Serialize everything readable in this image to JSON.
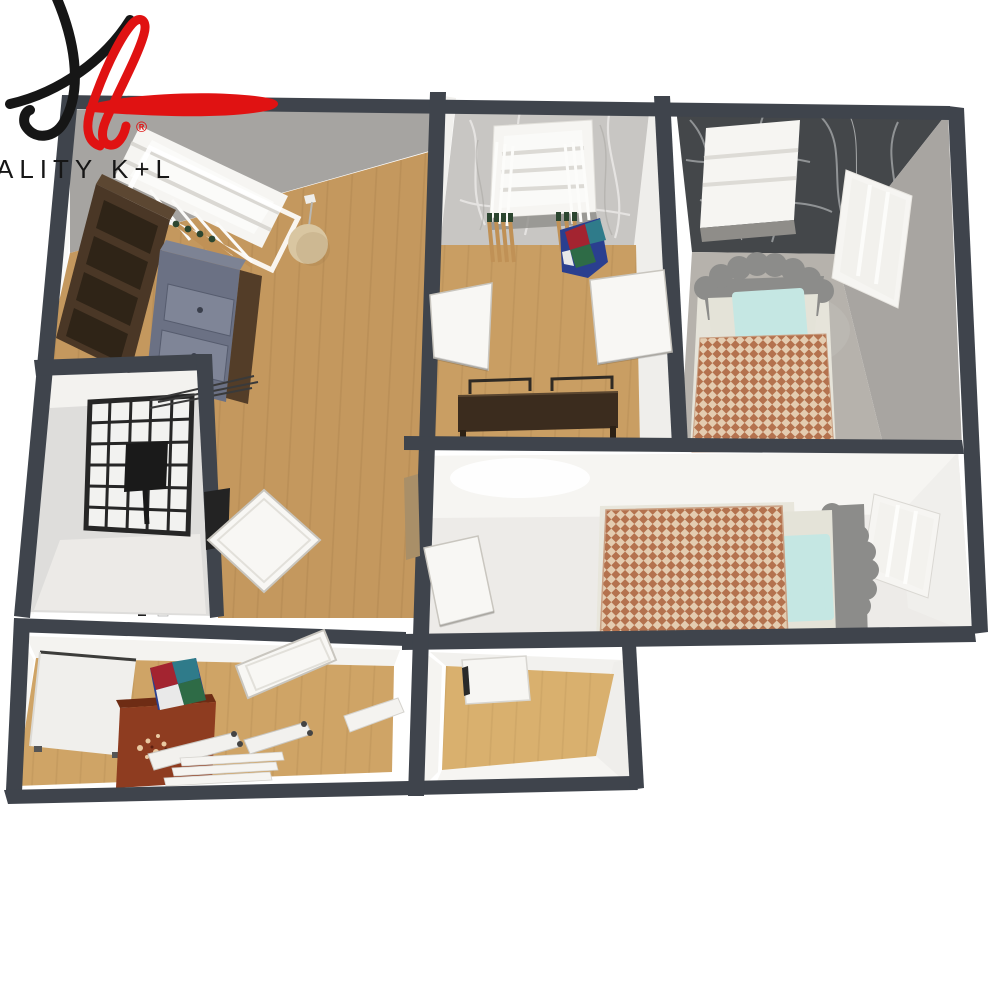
{
  "meta": {
    "kind": "3d-floorplan-render",
    "width": 1000,
    "height": 1000
  },
  "logo": {
    "brand_text": "ALITY K+L",
    "registered_mark": "®",
    "monogram": "K+L"
  },
  "palette": {
    "wall_dark": "#3f444c",
    "face_gray": "#a6a4a1",
    "face_white": "#f3f2ef",
    "marble_dark": "#44474a",
    "marble_light": "#c8c6c3",
    "wood_living": "#c4985e",
    "wood_kids": "#c99e63",
    "wood_office": "#cfa466",
    "wood_small": "#d9b06e",
    "floor_gray": "#b6b2ac",
    "floor_light": "#edebe8",
    "check_a": "#b4724e",
    "check_b": "#e4ccb0",
    "pillow": "#c5e7e3",
    "mattress": "#e4e3d8",
    "headboard": "#8c8c8a",
    "wardrobe": "#4a3726",
    "wardrobe_panel": "#2f2417",
    "dresser": "#6b7184",
    "dresser_front": "#7f8597",
    "side_brown": "#533d28",
    "desk": "#3b2c1e",
    "cabinet_red": "#8e3c20",
    "lantern": "#d9c6a1",
    "door_white": "#f8f7f4",
    "door_edge": "#c9c6bf",
    "window_white": "#f6f5f2",
    "grid_dark": "#262626",
    "stick": "#c09156",
    "stick_tip": "#2c4630",
    "logo_red": "#e01212",
    "logo_black": "#161616",
    "patch": [
      "#2a3f8f",
      "#a32430",
      "#2e6b46",
      "#2f7b8a",
      "#e9e9e9"
    ]
  },
  "rooms": [
    {
      "id": "living-room",
      "floor": "wood"
    },
    {
      "id": "kids-room",
      "floor": "wood"
    },
    {
      "id": "bedroom-top-right",
      "floor": "gray"
    },
    {
      "id": "bedroom-middle",
      "floor": "light"
    },
    {
      "id": "bathroom",
      "floor": "light"
    },
    {
      "id": "hallway",
      "floor": "wood"
    },
    {
      "id": "office-room",
      "floor": "wood"
    },
    {
      "id": "small-room",
      "floor": "wood"
    }
  ]
}
